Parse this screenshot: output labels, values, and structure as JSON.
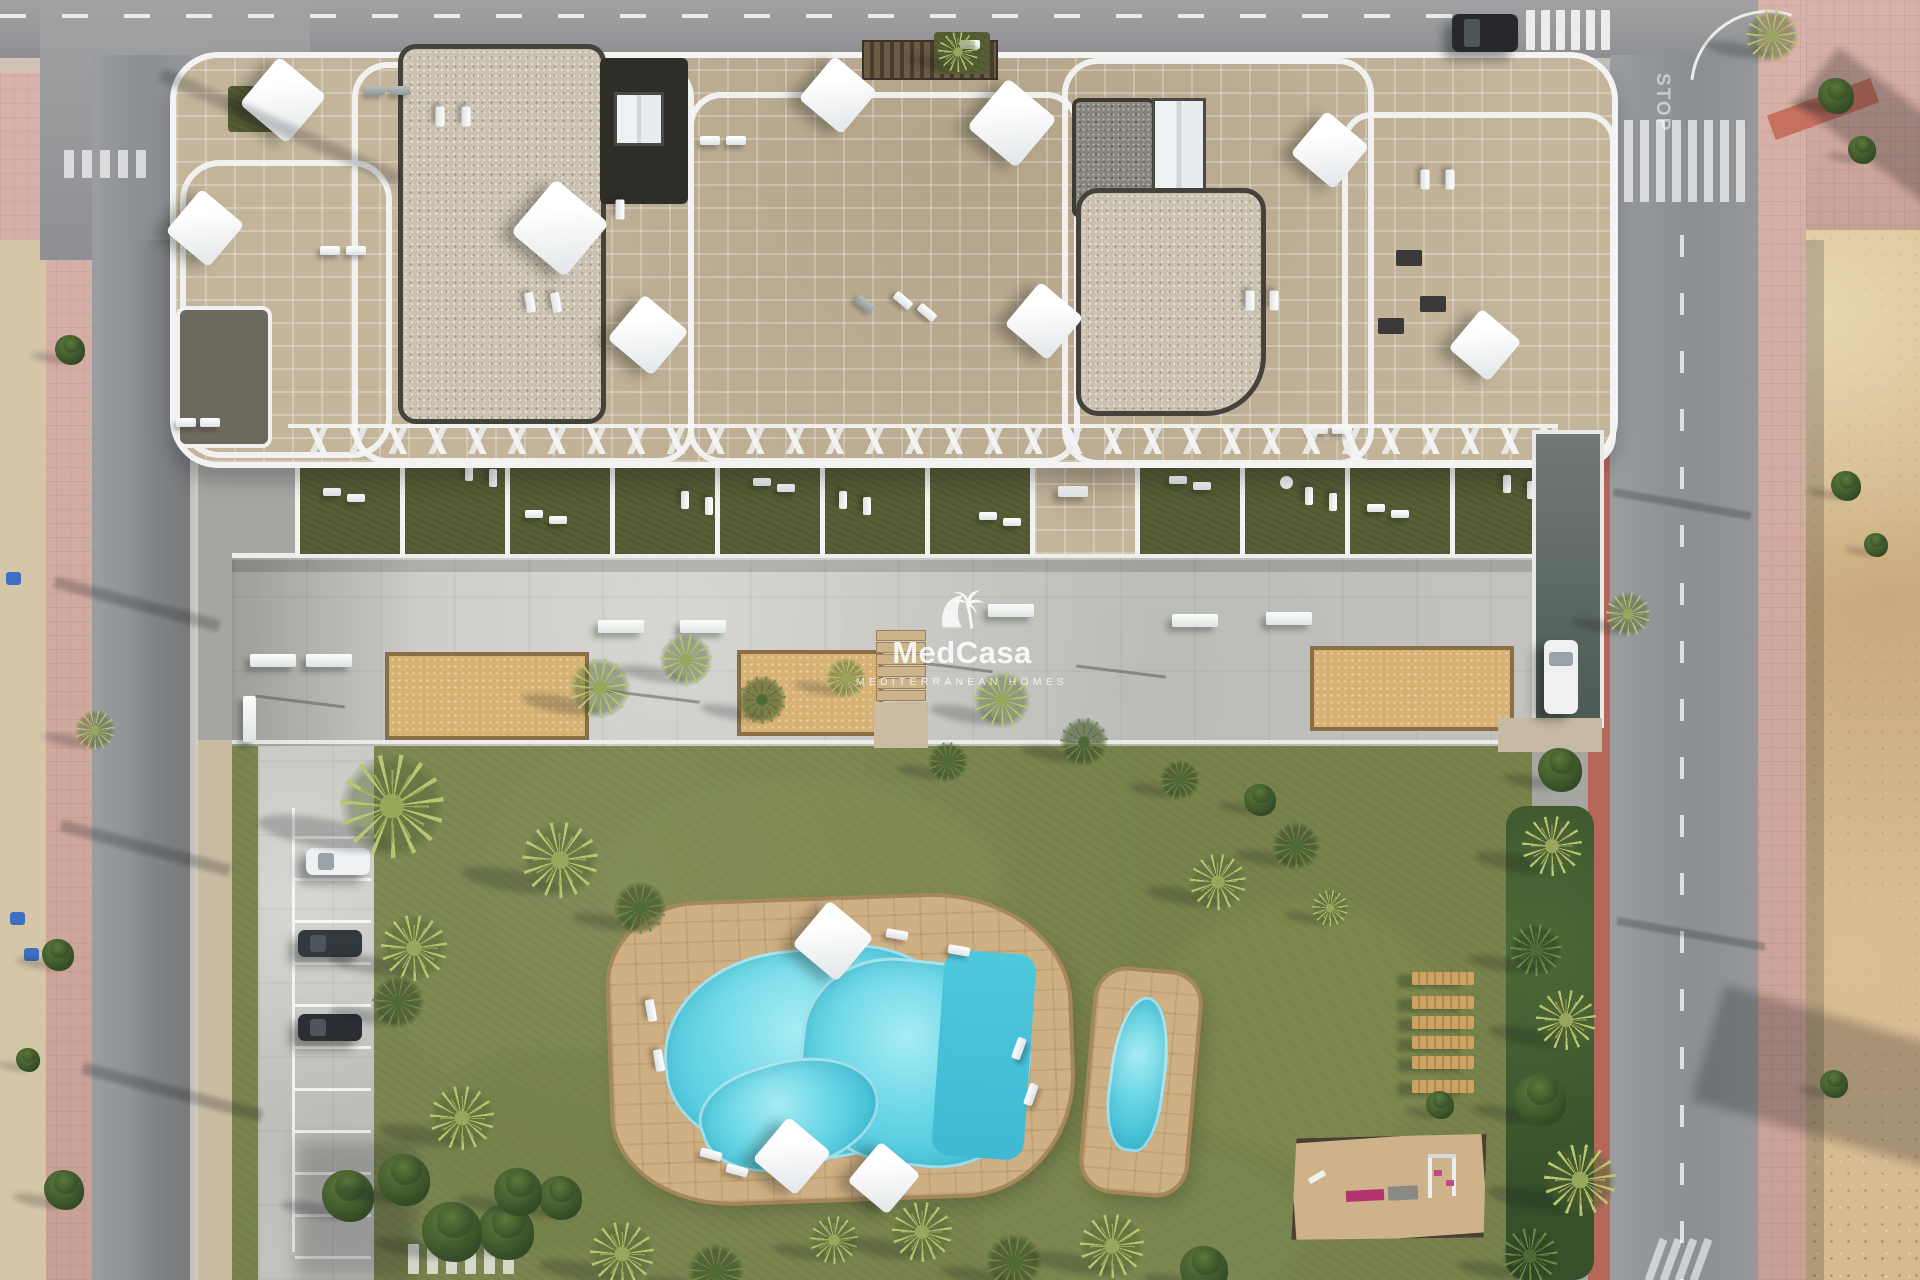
{
  "watermark": {
    "brand": "MedCasa",
    "tagline": "MEDITERRANEAN HOMES",
    "logo_icon": "palm-arch-logo"
  },
  "road_markings": {
    "stop": "STOP"
  },
  "colors": {
    "road_asphalt": "#97999b",
    "building_white": "#f2f3f2",
    "stone_roof": "#c3b49a",
    "gravel_roof_light": "#cbc1b0",
    "gravel_roof_dark": "#8a857c",
    "dark_roof": "#2e2d2a",
    "terrace_grass": "#575d34",
    "garden_grass": "#78834c",
    "deck_concrete": "#c6c5c1",
    "sand_court": "#d7b274",
    "pool_water": "#55cde0",
    "pool_deck_stone": "#cfb084",
    "sidewalk_pink": "#d3a89d",
    "dirt_sand": "#d6bb90",
    "bench_wood": "#c49a5e",
    "playground_pink": "#b23272",
    "car_dark": "#26282b",
    "car_white": "#eef0f2",
    "bin_blue": "#3f6fc2"
  }
}
